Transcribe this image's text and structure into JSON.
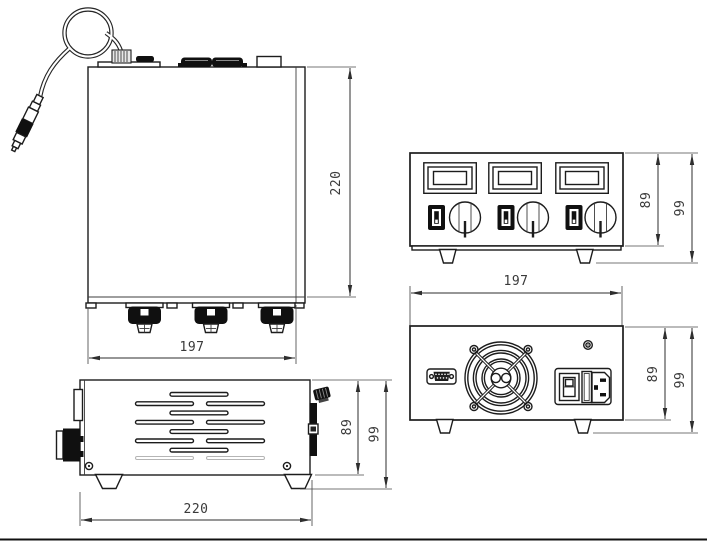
{
  "dimensions": {
    "top_view": {
      "height_mm": "220",
      "width_mm": "197"
    },
    "side_view": {
      "body_height_mm": "89",
      "overall_height_mm": "99",
      "length_mm": "220"
    },
    "front_view": {
      "body_height_mm": "89",
      "overall_height_mm": "99",
      "width_mm": "197"
    },
    "rear_view": {
      "body_height_mm": "89",
      "overall_height_mm": "99"
    }
  }
}
